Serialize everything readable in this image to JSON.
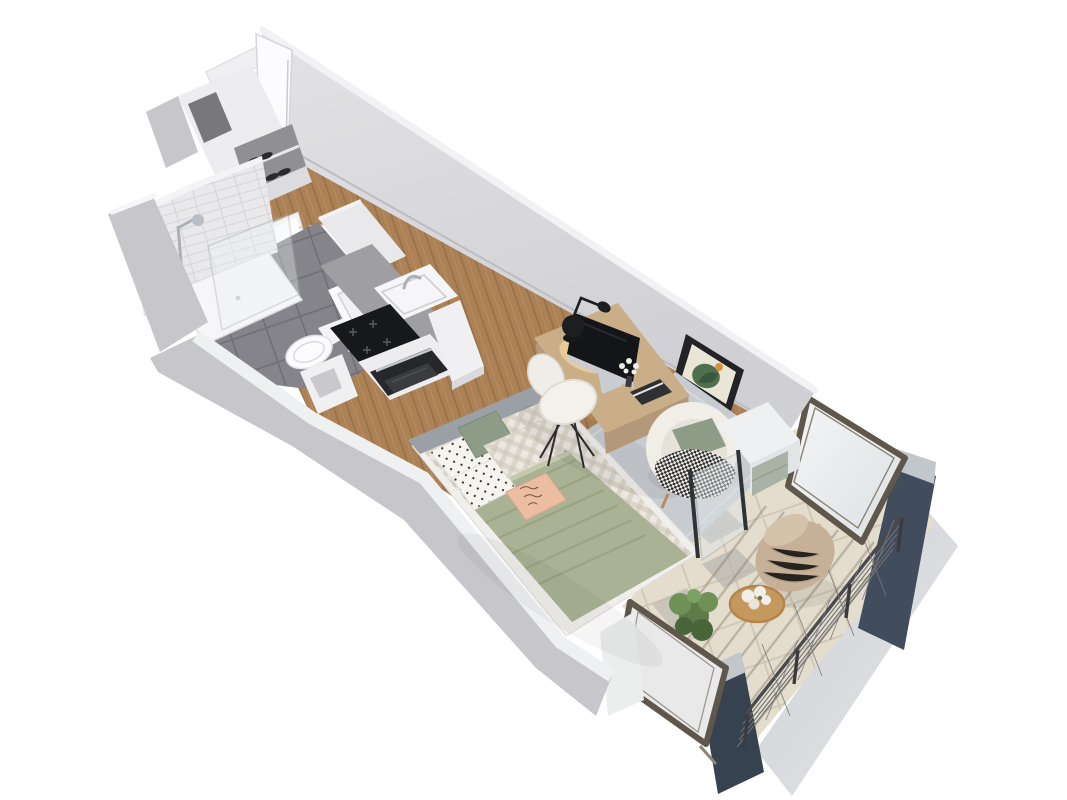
{
  "meta": {
    "description": "3D isometric cutaway render of a studio apartment floor plan on a white background",
    "view": "axonometric bird's-eye view, unit runs diagonally from entry at top-left to balcony at bottom-right",
    "visible_text": "none (peach bed cushion carries illegible decorative script)"
  },
  "rooms": [
    {
      "name": "entry",
      "features": [
        "open white entry door",
        "built-in closet with shoe shelves",
        "towel radiator",
        "open bathroom door"
      ]
    },
    {
      "name": "bathroom",
      "features": [
        "walk-in shower with white subway tile and glass screen",
        "chrome shower column",
        "white shower tray",
        "dark grey floor tiles",
        "wall-hung toilet",
        "white washbasin",
        "storage half-wall with niche"
      ]
    },
    {
      "name": "kitchenette",
      "features": [
        "grey countertop",
        "white sink with chrome mixer tap",
        "black induction cooktop",
        "built-in black oven",
        "white tall cabinet"
      ]
    },
    {
      "name": "living-sleeping-area",
      "features": [
        "oak plank flooring",
        "bed with grey headboard, gingham duvet, sage striped blanket, polka-dot / sage / gingham / peach script pillows",
        "light oak desk with iMac-style monitor, black task lamp, flowers, books",
        "wire chair with fleece pad",
        "framed botanical art with orange accent",
        "cream round armchair with sage pillow and checkered throw",
        "light grey rug",
        "white chest with sage drawers"
      ]
    },
    {
      "name": "balcony",
      "features": [
        "beige and grey floor tiles",
        "glass partition with dark posts",
        "two tilted floor-to-ceiling windows with bronze frames",
        "dark slate wall panels",
        "wire lattice railing",
        "beige outdoor lounge chair",
        "round wooden coffee table with white hydrangeas",
        "green shrub"
      ]
    }
  ],
  "palette": {
    "background": "#ffffff",
    "wall_face": "#d9d9dd",
    "wall_top": "#f2f2f4",
    "wall_outer": "#c6c6cb",
    "wood_floor": "#ac8156",
    "wood_line": "#96714a",
    "bath_tile": "#85848a",
    "shower_tile": "#e9e9ec",
    "fixture_white": "#fafafc",
    "counter_top": "#9e9ea3",
    "cooktop_black": "#17181b",
    "oven_black": "#26272b",
    "chrome": "#a9b0b7",
    "rug_gray": "#c8ccd1",
    "duvet_base": "#ece8e1",
    "duvet_check": "#cdc5b7",
    "blanket_green": "#aab295",
    "pillow_sage": "#8d9c87",
    "pillow_peach": "#ecbda0",
    "headboard_gray": "#9aa0a5",
    "desk_wood": "#c9ae88",
    "chair_fleece": "#f3f1ec",
    "art_frame": "#232327",
    "art_paper": "#eae6d6",
    "art_green": "#4f6f4e",
    "art_orange": "#d6913f",
    "armchair_cream": "#f1eee7",
    "chest_sage": "#a9b3a5",
    "balcony_tile": "#e4ddcd",
    "balcony_tile_gray": "#b7b5af",
    "slate_panel": "#414d5c",
    "window_frame": "#5f574b",
    "glass": "#eceef0",
    "railing": "#4a4a4e",
    "lounge_beige": "#c6b198",
    "table_wood": "#c5985e",
    "plant_green": "#5d7c49",
    "flowers_white": "#f1efe9",
    "lamp_black": "#1d1e20",
    "glow_warm": "#ffdf9e",
    "monitor_dark": "#141519"
  }
}
